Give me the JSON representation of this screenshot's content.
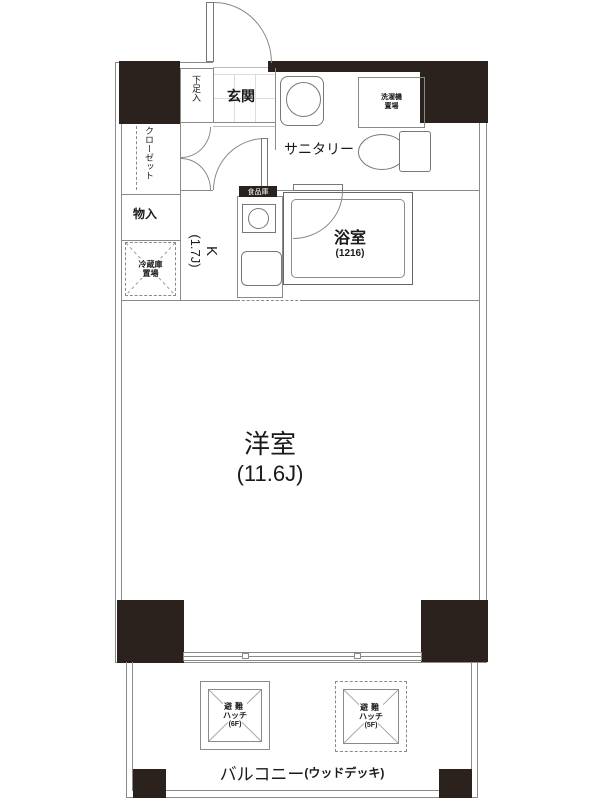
{
  "colors": {
    "wall": "#2b211d",
    "line": "#8a8a8a",
    "fixture": "#777777",
    "text": "#1a1a1a"
  },
  "labels": {
    "genkan": "玄関",
    "shoe_cabinet": "下足入",
    "closet": "クローゼット",
    "storage": "物入",
    "fridge_line1": "冷蔵庫",
    "fridge_line2": "置場",
    "pantry": "食品庫",
    "kitchen_line1": "K",
    "kitchen_line2": "(1.7J)",
    "sanitary": "サニタリー",
    "laundry_line1": "洗濯機",
    "laundry_line2": "置場",
    "bathroom": "浴室",
    "bathroom_size": "(1216)",
    "western_room": "洋室",
    "western_room_size": "(11.6J)",
    "hatch_left_line1": "避難",
    "hatch_left_line2": "ハッチ",
    "hatch_left_line3": "(6F)",
    "hatch_right_line1": "避難",
    "hatch_right_line2": "ハッチ",
    "hatch_right_line3": "(5F)",
    "balcony": "バルコニー",
    "balcony_note": "(ウッドデッキ)"
  }
}
